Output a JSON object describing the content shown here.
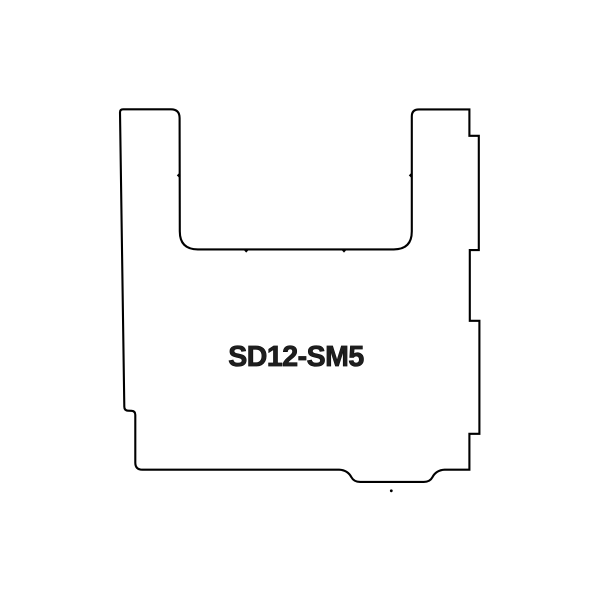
{
  "page": {
    "background": "#ffffff",
    "width": 600,
    "height": 600
  },
  "diagram": {
    "label": {
      "text": "SD12-SM5",
      "x": 296,
      "y": 366,
      "font_size": 28.5,
      "fill": "#1e1e1e",
      "stroke": "#000000",
      "stroke_width": 0.8
    },
    "outline": {
      "stroke": "#000000",
      "stroke_width": 2.1,
      "fill": "#ffffff",
      "path": "M 120.0 112.4 Q 120.0 109.3 123.1 109.3 L 170.9 109.3 Q 179.6 109.3 179.6 118.0 L 179.8 231.4 Q 179.8 249.4 197.8 249.4 L 393.8 249.4 Q 411.8 249.4 411.8 231.4 L 411.8 116.4 Q 411.8 109.4 418.8 109.4 L 469.4 109.4 L 469.4 135.8 L 478.8 135.8 L 478.8 250.1 L 469.8 250.1 L 469.8 320.8 L 479.4 320.8 L 479.4 433.8 L 469.4 433.8 L 469.4 469.7 L 444.6 469.7 C 437.9 470.0 434.4 473.5 432.4 477.2 Q 429.9 481.9 423.8 481.9 L 360.2 481.9 Q 353.8 481.9 351.4 477.2 C 349.4 473.5 345.8 470.0 339.2 469.7 L 142.4 469.7 Q 135.3 469.7 135.3 462.6 L 135.3 414.9 Q 135.3 411.0 131.5 410.8 L 128.2 410.7 Q 124.3 410.5 124.3 406.6 L 120.0 112.4 Z"
    },
    "notch_ticks": [
      {
        "name": "left-prong-inner-notch",
        "points": "179.8,172.4 176.8,175.4 179.8,178.4"
      },
      {
        "name": "right-prong-inner-notch",
        "points": "411.8,172.4 408.8,175.4 411.8,178.4"
      },
      {
        "name": "u-bottom-left-notch",
        "points": "243.2,249.4 246.2,252.6 249.2,249.4"
      },
      {
        "name": "u-bottom-right-notch",
        "points": "341.0,249.4 344.0,252.6 347.0,249.4"
      }
    ],
    "tick_color": "#000000",
    "stray_dot": {
      "cx": 391.3,
      "cy": 490.8,
      "r": 1.4,
      "fill": "#000000"
    }
  }
}
